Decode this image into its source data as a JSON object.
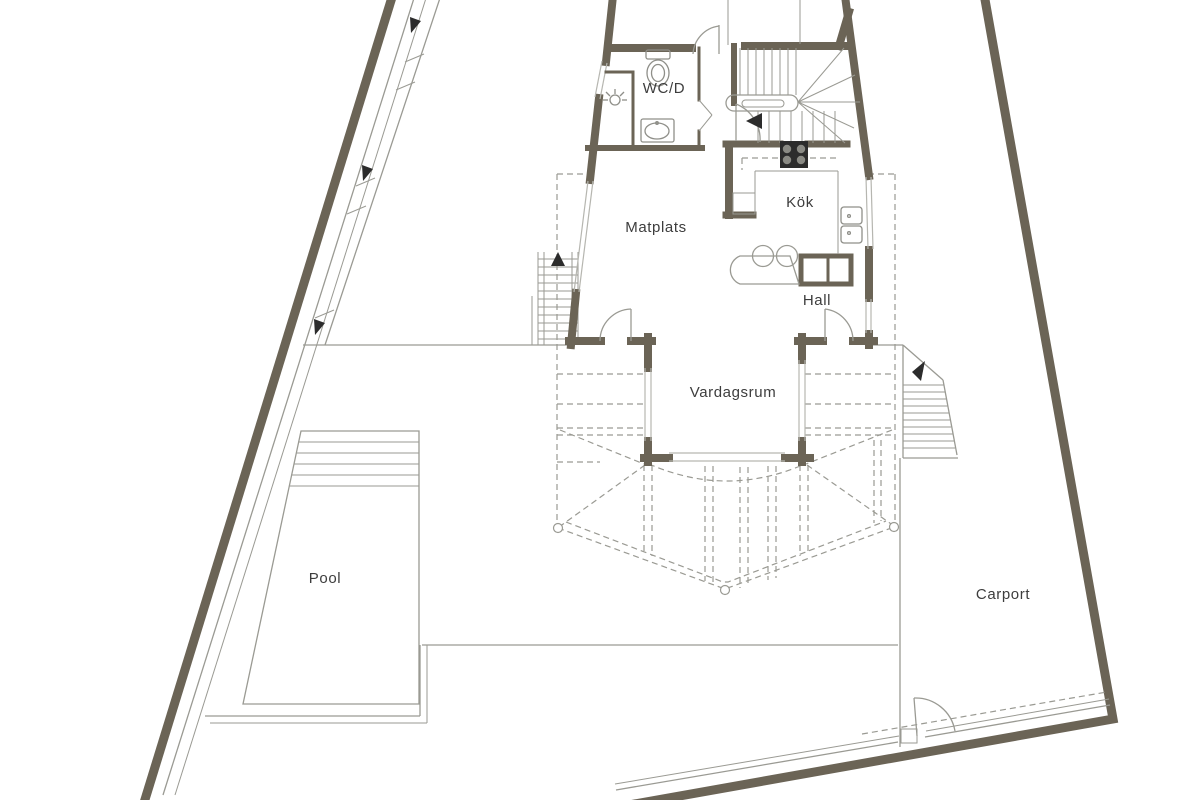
{
  "plan": {
    "type": "architectural-floor-plan",
    "rooms": {
      "wc": "WC/D",
      "kitchen": "Kök",
      "dining": "Matplats",
      "hall": "Hall",
      "living": "Vardagsrum",
      "pool": "Pool",
      "carport": "Carport"
    },
    "colors": {
      "wall": "#6b6456",
      "line": "#9a9a93",
      "light": "#b6b6b0",
      "text": "#3d3d3d",
      "fixture": "#8f8f89",
      "dark": "#2c2c2c",
      "bg": "#ffffff"
    }
  }
}
